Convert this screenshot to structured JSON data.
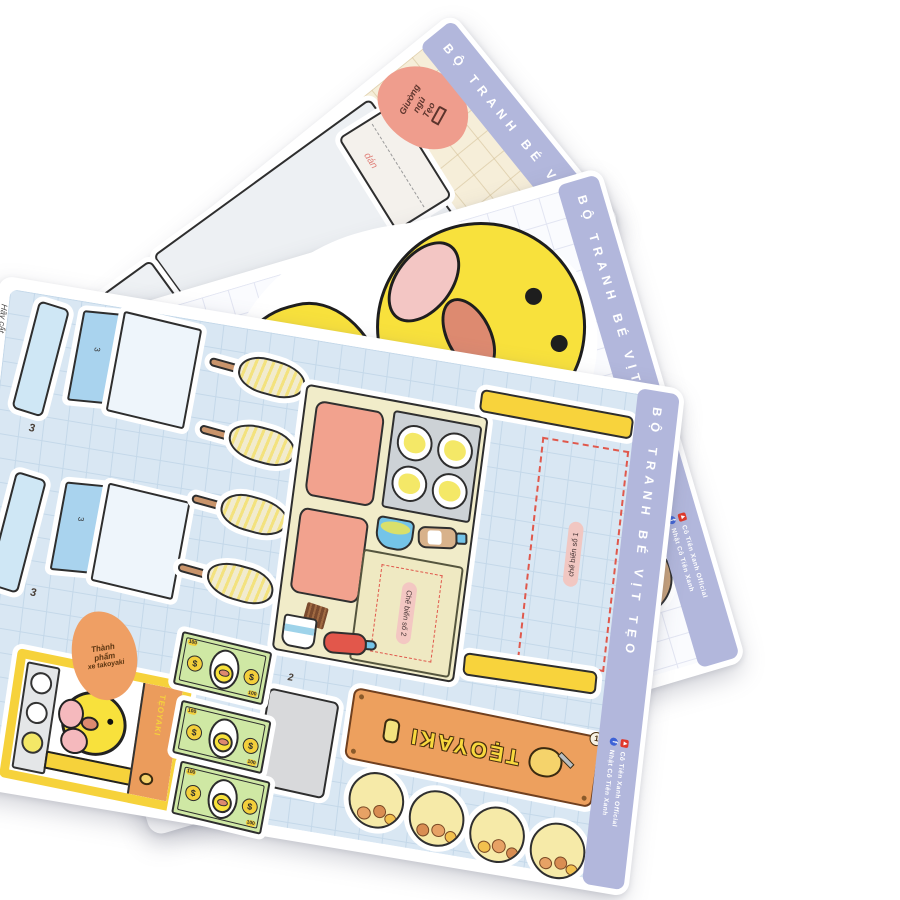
{
  "palette": {
    "strip_lavender": "#b2b7dc",
    "sheet_blue": "#d9e7f3",
    "sheet_cream": "#f6eed9",
    "duck_yellow": "#f8e13c",
    "banner_orange": "#eda05e",
    "youtube_red": "#e0392b",
    "facebook_blue": "#3d62d6",
    "money_green": "#cfe8a4",
    "counter_yellow": "#f8d33c"
  },
  "strip": {
    "title": "BỘ TRANH BÉ VỊT TẸO",
    "social": [
      {
        "name": "youtube",
        "label": "Cô Tiên Xanh Official"
      },
      {
        "name": "facebook",
        "label": "Nhật Cô Tiên Xanh"
      }
    ]
  },
  "bed_sheet": {
    "note_lines": [
      "Giường",
      "ngủ",
      "Tẹo"
    ],
    "glue_label": "dán"
  },
  "takoyaki_sheet": {
    "cut_note": "Hãy cắt",
    "stand_number": "3",
    "piece_number_1": "1",
    "piece_number_2": "2",
    "station_label_1": "chế biến số 1",
    "station_label_2": "Chế biến số 2",
    "finished_note_lines": [
      "Thành",
      "phẩm",
      "xe takoyaki"
    ],
    "banner_text": "TẸOYAKI",
    "money": {
      "symbol": "$",
      "corner_value": "100"
    }
  }
}
